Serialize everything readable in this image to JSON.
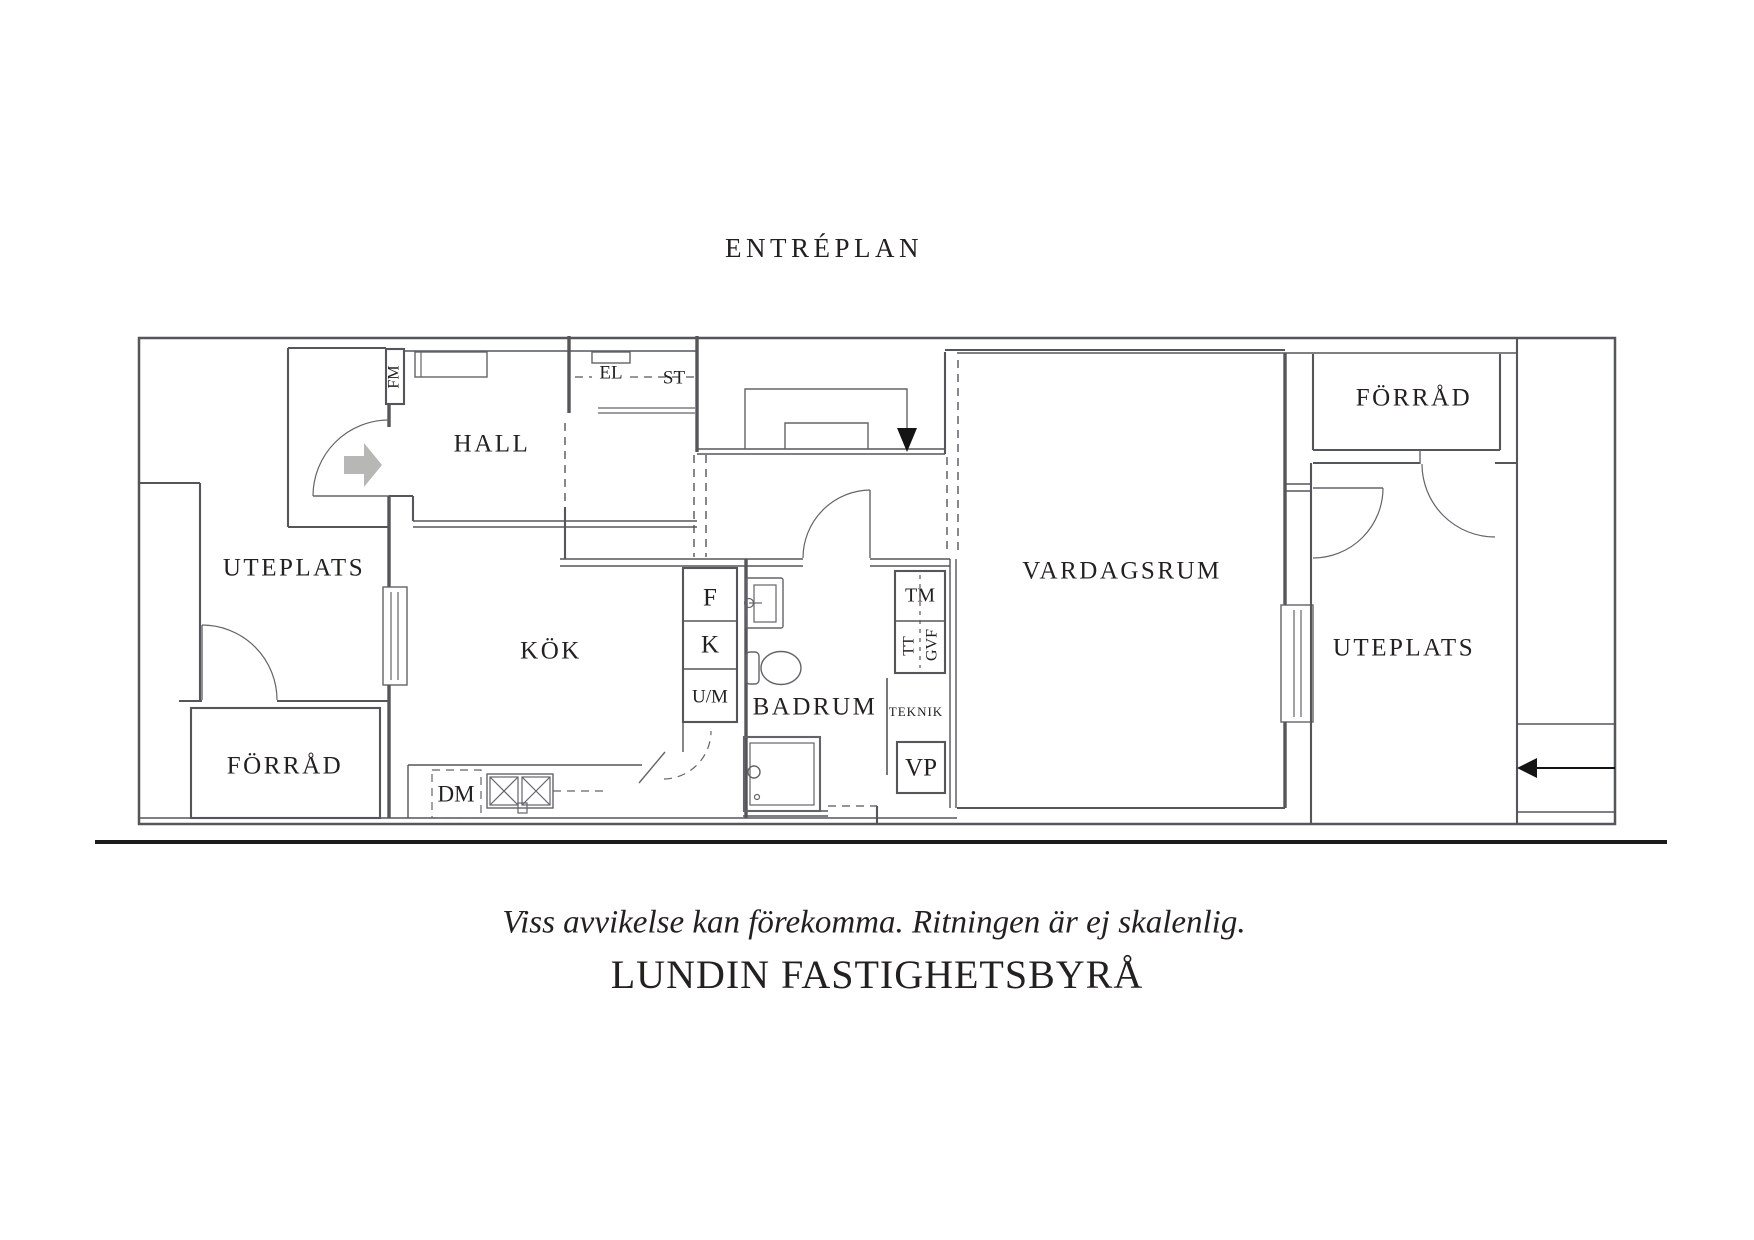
{
  "title": "ENTRÉPLAN",
  "rooms": {
    "hall": "HALL",
    "kok": "KÖK",
    "badrum": "BADRUM",
    "vardagsrum": "VARDAGSRUM",
    "uteplats_left": "UTEPLATS",
    "uteplats_right": "UTEPLATS",
    "forrad_left": "FÖRRÅD",
    "forrad_right": "FÖRRÅD"
  },
  "fixtures": {
    "fm": "FM",
    "el": "EL",
    "st": "ST",
    "f": "F",
    "k": "K",
    "um": "U/M",
    "dm": "DM",
    "tm": "TM",
    "tt": "TT",
    "gvf": "GVF",
    "teknik": "TEKNIK",
    "vp": "VP"
  },
  "footer": {
    "disclaimer": "Viss avvikelse kan förekomma. Ritningen är ej skalenlig.",
    "brand": "LUNDIN FASTIGHETSBYRÅ"
  },
  "colors": {
    "background": "#ffffff",
    "wall": "#55565a",
    "text": "#232120",
    "entry_arrow": "#b7b7b5",
    "stair_arrow": "#141414",
    "rule": "#1c1c1c"
  }
}
